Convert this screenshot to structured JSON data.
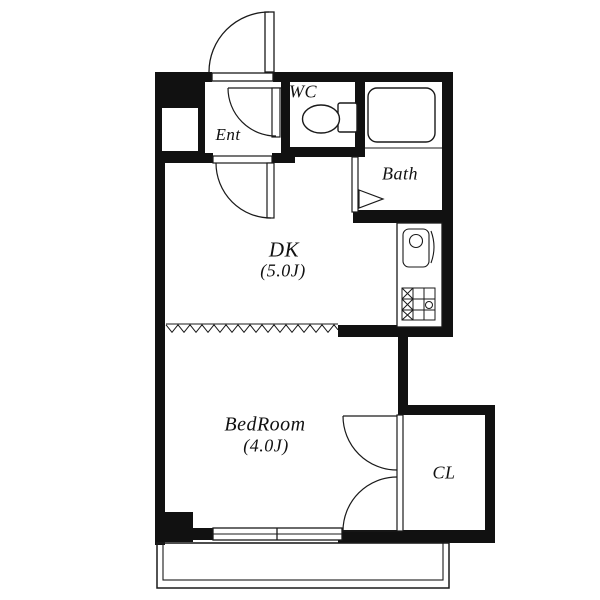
{
  "floorplan": {
    "rooms": {
      "ent": {
        "label": "Ent"
      },
      "wc": {
        "label": "WC"
      },
      "bath": {
        "label": "Bath"
      },
      "dk": {
        "label": "DK",
        "area": "(5.0J)"
      },
      "bedroom": {
        "label": "BedRoom",
        "area": "(4.0J)"
      },
      "cl": {
        "label": "CL"
      }
    },
    "fixtures": [
      "entrance-door",
      "wc-door",
      "dk-door",
      "bath-folding-door",
      "closet-double-door",
      "toilet",
      "bathtub",
      "kitchen-sink",
      "gas-stove",
      "sliding-window",
      "accordion-partition",
      "balcony",
      "meter-box"
    ],
    "colors": {
      "wall": "#111111",
      "floor": "#ffffff",
      "outline": "#1a1a1a"
    }
  }
}
